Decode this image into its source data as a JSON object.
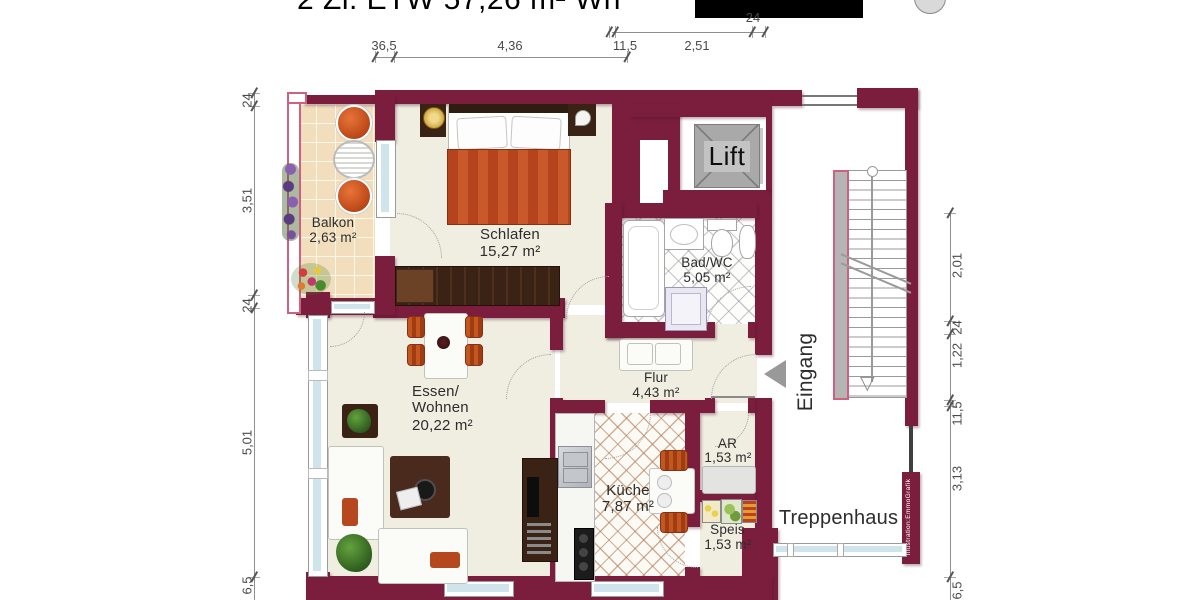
{
  "title": {
    "text": "2 Zi. ETW 57,26 m² Wh"
  },
  "rooms": {
    "balkon": {
      "name": "Balkon",
      "area": "2,63 m²"
    },
    "schlafen": {
      "name": "Schlafen",
      "area": "15,27 m²"
    },
    "bad": {
      "name": "Bad/WC",
      "area": "5,05 m²"
    },
    "flur": {
      "name": "Flur",
      "area": "4,43 m²"
    },
    "wohnen": {
      "name": "Essen/",
      "name2": "Wohnen",
      "area": "20,22 m²"
    },
    "kueche": {
      "name": "Küche",
      "area": "7,87 m²"
    },
    "ar": {
      "name": "AR",
      "area": "1,53 m²"
    },
    "speis": {
      "name": "Speis",
      "area": "1,53 m²"
    }
  },
  "labels": {
    "lift": "Lift",
    "eingang": "Eingang",
    "treppenhaus": "Treppenhaus",
    "credit": "Illustration:EmmoGrafik"
  },
  "dimensions": {
    "top": [
      "36,5",
      "4,36",
      "11,5",
      "2,51",
      "24"
    ],
    "left": [
      "24",
      "3,51",
      "24",
      "5,01",
      "6,5"
    ],
    "right": [
      "2,01",
      "24",
      "1,22",
      "11,5",
      "3,13",
      "6,5"
    ]
  },
  "colors": {
    "wall": "#7b1e3d",
    "floor": "#f0ede1",
    "balcony_floor": "#f2debc",
    "glass": "#cfe4eb",
    "accent_rail": "#d06080",
    "lift_gray": "#a9a9a9",
    "arrow_gray": "#999999",
    "furniture_orange": "#b5481e",
    "furniture_brown": "#3a2214",
    "dim_text": "#4a4a4a"
  }
}
